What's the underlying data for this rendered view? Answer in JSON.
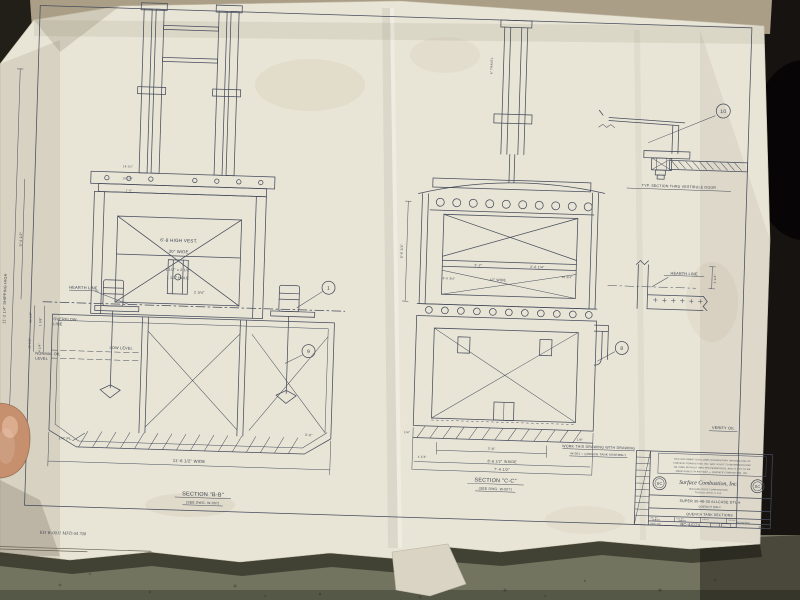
{
  "margin": {
    "shipping_height": "11'-2 1/4\" SHIPPING HIGH",
    "shipping_width": "6'-4 1/2\"",
    "stamp": "KH W-0011 MFD 04 700"
  },
  "left_view": {
    "caption": "SECTION \"B-B\"",
    "subcaption": "(SEE DWG. W-007)",
    "callout_a": "1",
    "callout_b": "9",
    "labels": {
      "hearth": "HEARTH LINE",
      "overflow_1": "OVERFLOW",
      "overflow_2": "LINE",
      "normal_oil_1": "NORMAL OIL",
      "normal_oil_2": "LEVEL",
      "low_level": "LOW LEVEL"
    },
    "dims": {
      "vest_height": "6'-8 HIGH VEST.",
      "vest_width": "30\" WIDE",
      "slot": "1 1/2\" x 2 1/2\"",
      "hole": "1 1/2\" HOLE",
      "lip": "2 3/4\"",
      "plate": "1/4\" PL.",
      "overall_width": "11'-6 1/2\" WIDE",
      "corner": "3'-0\"",
      "s1": "18 1/2\"",
      "s2": "10 1/4\"",
      "s3": "1'-0\"",
      "r1": "10 1/2\"",
      "r2": "1 3/8\"",
      "r3": "13 1/8\"",
      "r4": "4 1/4\""
    }
  },
  "right_view": {
    "caption": "SECTION \"C-C\"",
    "subcaption": "(SEE DWG. W-007)",
    "callout_a": "8",
    "dims": {
      "d1": "3'-2\"",
      "d2": "2'-6 1/4\"",
      "d3": "42\" WIDE",
      "d4": "3'-6 3/4\"",
      "d5": "10 3/4\"",
      "d6": "1/4\"",
      "d7": "3'-6\"",
      "d8": "4 1/4\"",
      "inside": "6'-6 1/2\" INSIDE",
      "overall": "7'-4 1/2\"",
      "left_height": "5'-0 1/4\"",
      "travel": "6\" TRAVEL"
    }
  },
  "door_detail": {
    "callout": "10",
    "caption": "TYP. SECTION THRU VESTIBULE DOOR"
  },
  "hearth_detail": {
    "label": "HEARTH LINE",
    "dim": "5 1/4\""
  },
  "notes": {
    "work_line_1": "WORK THIS DRAWING WITH DRAWING",
    "work_line_2": "W-001 = QUENCH TANK ASSEMBLY",
    "verify": "VERIFY OIL",
    "small_dim": "1/8\""
  },
  "title_block": {
    "disclaimer_1": "THIS DOCUMENT DISCLOSES PROPRIETARY INFORMATION OF",
    "disclaimer_2": "SURFACE COMBUSTION, INC. AND IS NOT TO BE REPRODUCED",
    "disclaimer_3": "OR USED WITHOUT WRITTEN PERMISSION, AND IS NOT TO BE",
    "disclaimer_4": "MADE PUBLIC IN ANY WAY — SURFACE COMBUSTION, INC.",
    "logo": "SC",
    "company": "Surface Combustion, Inc.",
    "company_sub_1": "MIDLAND-ROSS CORPORATION",
    "company_sub_2": "TOLEDO, OHIO, U.S.A.",
    "title_1": "SUPER 30-48-30 ALLCASE DTL #",
    "title_2": "QUENCH ONLY",
    "title_3": "QUENCH TANK SECTIONS",
    "dr_label": "DR. BY",
    "ch_label": "CH. BY",
    "app_label": "APP'D",
    "scale_label": "SCALE",
    "date_1": "9/8/70",
    "date_2": "9/8/70",
    "scale_value": "AS NOTED",
    "dwg_label": "DWG. NO.",
    "dwg_no": "RC-44124",
    "sheet": "001"
  }
}
